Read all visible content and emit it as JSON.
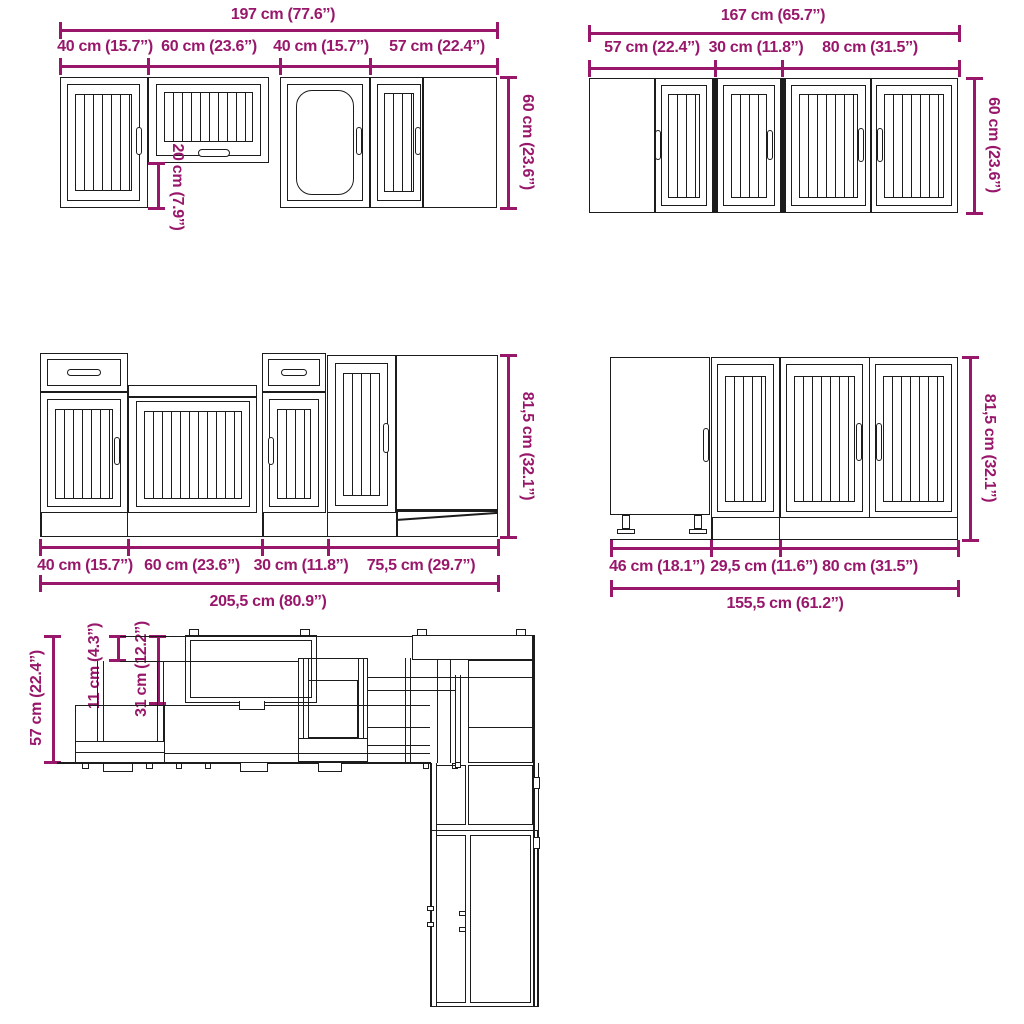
{
  "colors": {
    "dimension": "#98176b",
    "line": "#1c1c1c",
    "background": "#ffffff"
  },
  "views": {
    "wall_left": {
      "total": "197 cm (77.6’’)",
      "segments": [
        "40 cm (15.7’’)",
        "60 cm (23.6’’)",
        "40 cm (15.7’’)",
        "57 cm (22.4’’)"
      ],
      "height": "60 cm (23.6’’)",
      "upper_gap": "20 cm (7.9’’)"
    },
    "wall_right": {
      "total": "167 cm (65.7’’)",
      "segments": [
        "57 cm (22.4’’)",
        "30 cm (11.8’’)",
        "80 cm (31.5’’)"
      ],
      "height": "60 cm (23.6’’)"
    },
    "base_left": {
      "total": "205,5 cm (80.9’’)",
      "segments": [
        "40 cm (15.7’’)",
        "60 cm (23.6’’)",
        "30 cm (11.8’’)",
        "75,5 cm (29.7’’)"
      ],
      "height": "81,5 cm (32.1’’)"
    },
    "base_right": {
      "total": "155,5 cm (61.2’’)",
      "segments": [
        "46 cm (18.1’’)",
        "29,5 cm (11.6’’)",
        "80 cm (31.5’’)"
      ],
      "height": "81,5 cm (32.1’’)"
    },
    "plan": {
      "counter_depth": "57 cm (22.4’’)",
      "overhang": "11 cm (4.3’’)",
      "wall_depth": "31 cm (12.2’’)"
    }
  }
}
